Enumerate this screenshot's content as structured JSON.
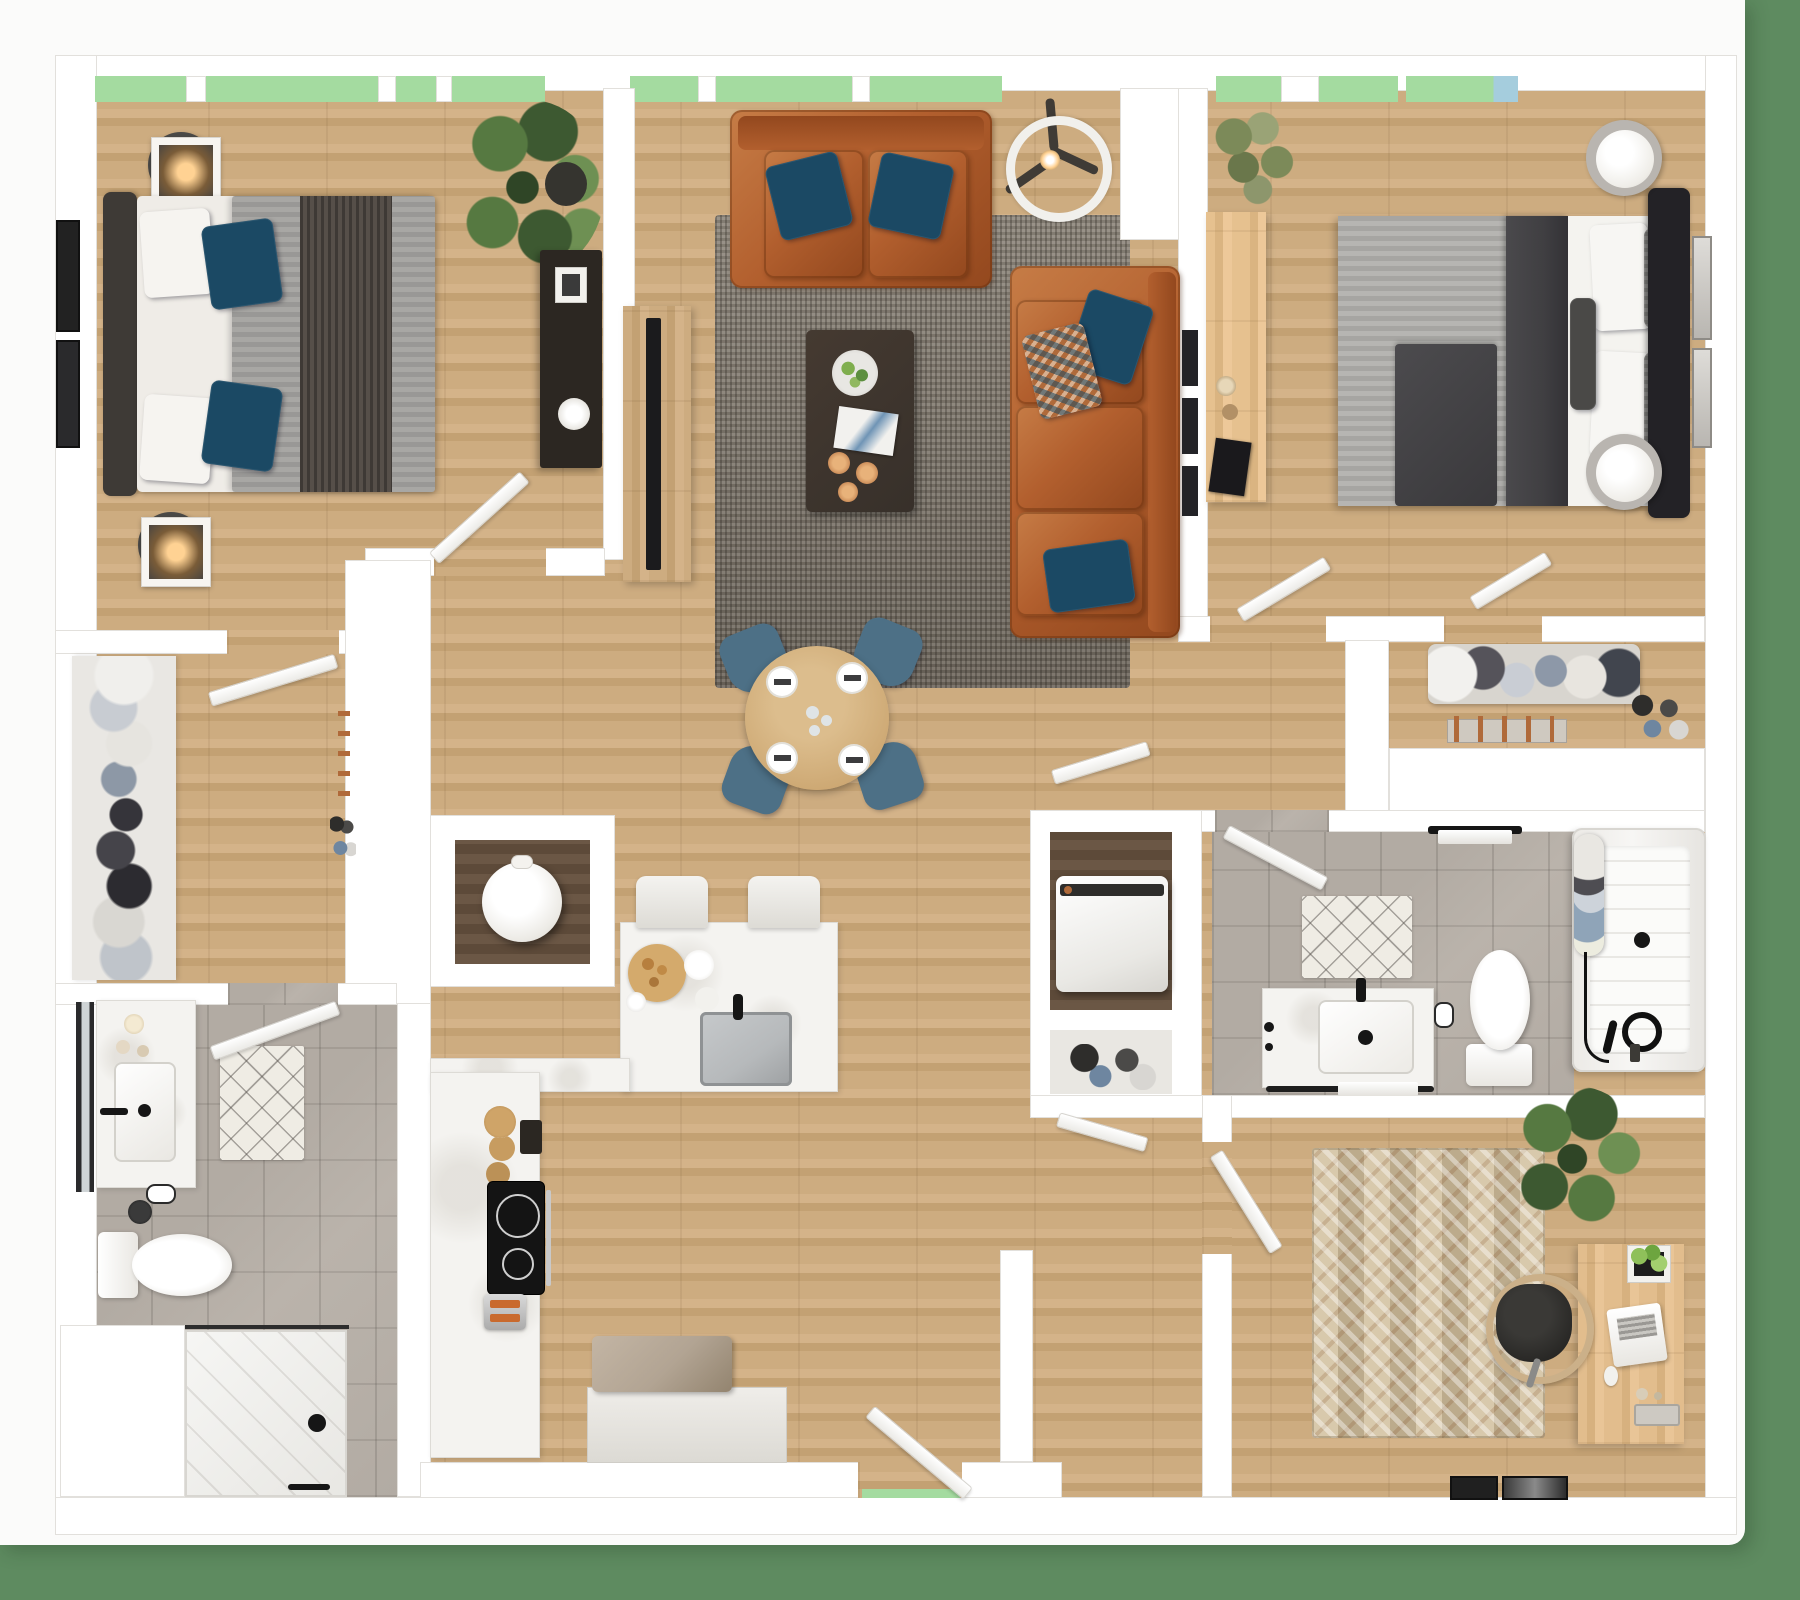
{
  "title": "apartment-3d-floor-plan",
  "palette": {
    "bg": "#5e8b60",
    "card": "#fbfbfa",
    "wall": "#ffffff",
    "wallEdge": "#e2e0dc",
    "wood1": "#cdac80",
    "wood2": "#c3a173",
    "wood3": "#d4b389",
    "woodDark": "#6b5745",
    "tile": "#b2aba3",
    "rugA": "#8e877c",
    "rugB": "#6e675d",
    "orugA": "#d8c9ac",
    "orugB": "#bcab8c",
    "leather": "#b25f2e",
    "leatherDk": "#93481e",
    "leatherLt": "#c67c46",
    "navy": "#1b4964",
    "mattress": "#efece7",
    "sheet": "#f4f3ef",
    "duvetA": "#a8a7a4",
    "duvetB": "#999896",
    "throw": "#564f49",
    "duvet2A": "#b6b5b2",
    "duvet2B": "#a6a5a2",
    "charcoal": "#403f42",
    "headboard1": "#3e3a36",
    "headboard2": "#232226",
    "tableWood": "#cda873",
    "chairBlue": "#4d7086",
    "espresso": "#37302a",
    "consoleDark": "#2c2722",
    "marble": "#f4f3f0",
    "steel": "#b6b9bb",
    "winGreen": "#a4dba0",
    "winBlue": "#a5cddd",
    "plantD": "#3d5931",
    "plantM": "#567941",
    "plantL": "#6e9053",
    "olive": "#7c8a59",
    "copper": "#b06a3a",
    "taupe": "#b2a493",
    "glow": "#ffd293",
    "black": "#161616"
  },
  "floor_plan": {
    "style": "photorealistic top-down 3D render",
    "rooms": [
      {
        "name": "bedroom-1",
        "floor": "wood",
        "furniture": [
          "double-bed-gray-striped-duvet",
          "dark-headboard",
          "2-round-nightstands",
          "2-square-frame-lamps",
          "2-wall-art-frames",
          "monstera-plant",
          "dark-console-table",
          "door"
        ]
      },
      {
        "name": "living-room",
        "floor": "wood",
        "furniture": [
          "orange-leather-loveseat",
          "orange-leather-sofa",
          "4-navy-pillows",
          "patterned-pillow",
          "gray-shag-rug",
          "espresso-coffee-table",
          "decor-plate-book-candles",
          "tv-console",
          "tv",
          "ceiling-fan",
          "wall-shelf-frames"
        ]
      },
      {
        "name": "dining-area",
        "floor": "wood",
        "furniture": [
          "round-wood-table",
          "4-blue-chairs",
          "4-place-settings",
          "glassware"
        ]
      },
      {
        "name": "bedroom-2",
        "floor": "wood",
        "furniture": [
          "double-bed-gray-duvet",
          "charcoal-throw",
          "black-headboard",
          "2-drum-lamps",
          "wood-desk",
          "notebook",
          "candles",
          "olive-plant",
          "2-wall-art-frames",
          "door",
          "closet-door"
        ]
      },
      {
        "name": "walk-in-closet",
        "floor": "wood",
        "furniture": [
          "clothes-shelves",
          "shoe-stacks",
          "hanger-rail",
          "door"
        ]
      },
      {
        "name": "bathroom-1",
        "floor": "tile",
        "furniture": [
          "vanity-sink",
          "mirror",
          "toilet",
          "diamond-bath-mat",
          "walk-in-shower",
          "toilet-paper-holder",
          "door"
        ]
      },
      {
        "name": "bathroom-2",
        "floor": "tile",
        "furniture": [
          "vanity-sink",
          "toilet",
          "bathtub-with-curtain",
          "diamond-bath-mat",
          "towel-bar",
          "black-fixtures",
          "door"
        ]
      },
      {
        "name": "kitchen",
        "floor": "wood",
        "furniture": [
          "l-shaped-counter",
          "peninsula-island",
          "undermount-sink",
          "black-faucet",
          "2-bar-stools",
          "cutting-board",
          "cooktop",
          "oven",
          "toaster",
          "entry-bench"
        ]
      },
      {
        "name": "laundry-closet",
        "floor": "dark-wood",
        "furniture": [
          "top-load-washer",
          "shoe-cubby"
        ]
      },
      {
        "name": "shoe-closet",
        "floor": "wood",
        "furniture": [
          "hanging-clothes",
          "shoe-rack-orange-pegs",
          "shoes"
        ]
      },
      {
        "name": "office",
        "floor": "wood",
        "furniture": [
          "chevron-rug",
          "wood-desk",
          "laptop",
          "mouse",
          "desk-plant",
          "desk-chair",
          "large-plant",
          "2-wall-art-frames",
          "door"
        ]
      },
      {
        "name": "entry",
        "floor": "wood",
        "furniture": [
          "front-door"
        ]
      }
    ],
    "windows": [
      "bedroom-1-top",
      "living-room-top",
      "bedroom-2-top-left",
      "bedroom-2-top-right"
    ],
    "background": "green"
  }
}
